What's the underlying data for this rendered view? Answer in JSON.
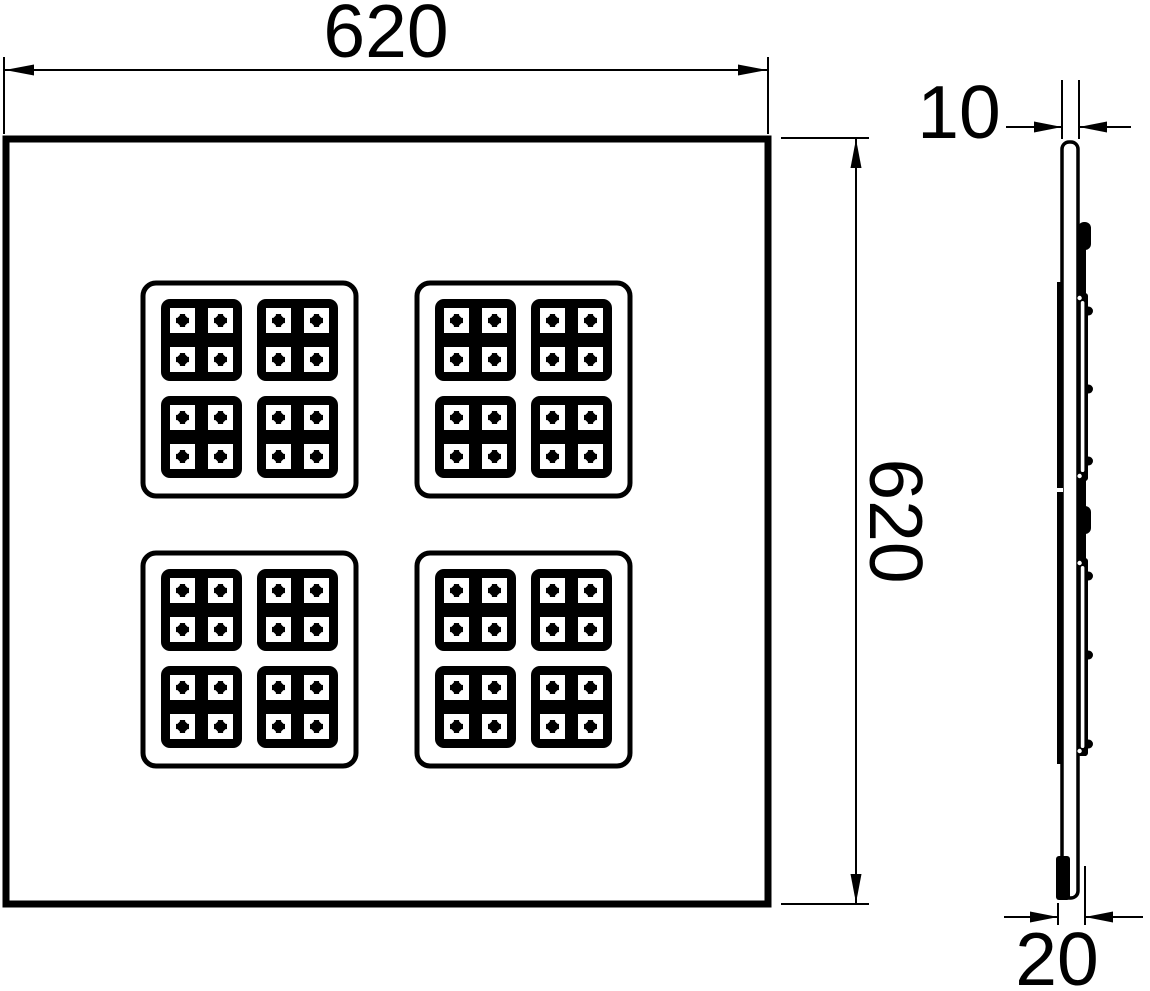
{
  "figure": {
    "kind": "technical-drawing",
    "description": "Flat LED panel luminaire: front view with four LED module clusters and side profile view with dimension annotations",
    "background_color": "#ffffff",
    "line_color": "#000000"
  },
  "front_view": {
    "width_dimension": "620",
    "height_dimension": "620",
    "led_cluster_count": 4,
    "modules_per_cluster": 4,
    "led_windows_per_module": 4
  },
  "side_view": {
    "panel_thickness_dimension": "10",
    "mounting_depth_dimension": "20"
  }
}
